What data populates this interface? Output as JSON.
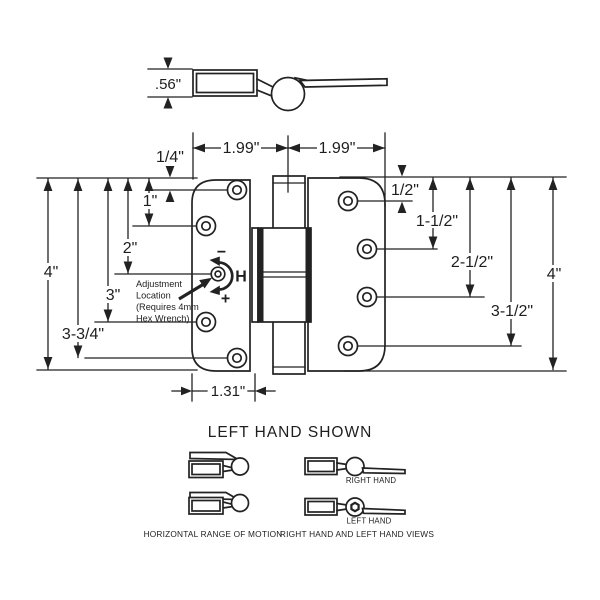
{
  "drawing": {
    "side_view": {
      "thickness_label": ".56\""
    },
    "plan_dims": {
      "left_width": "1.99\"",
      "right_width": "1.99\"",
      "bottom_offset": "1.31\""
    },
    "left_dims": {
      "d0": "1/4\"",
      "d1": "1\"",
      "d2": "2\"",
      "d3": "3\"",
      "d4": "3-3/4\"",
      "d5": "4\""
    },
    "right_dims": {
      "d0": "1/2\"",
      "d1": "1-1/2\"",
      "d2": "2-1/2\"",
      "d3": "3-1/2\"",
      "d4": "4\""
    },
    "adjustment": {
      "line1": "Adjustment",
      "line2": "Location",
      "line3": "(Requires 4mm",
      "line4": "Hex Wrench)",
      "minus_symbol": "−",
      "plus_symbol": "+",
      "axis_label": "H"
    },
    "legend": {
      "title": "LEFT HAND SHOWN",
      "range_caption": "HORIZONTAL RANGE OF MOTION",
      "views_caption": "RIGHT HAND AND LEFT HAND VIEWS",
      "right_hand_label": "RIGHT HAND",
      "left_hand_label": "LEFT HAND"
    }
  }
}
